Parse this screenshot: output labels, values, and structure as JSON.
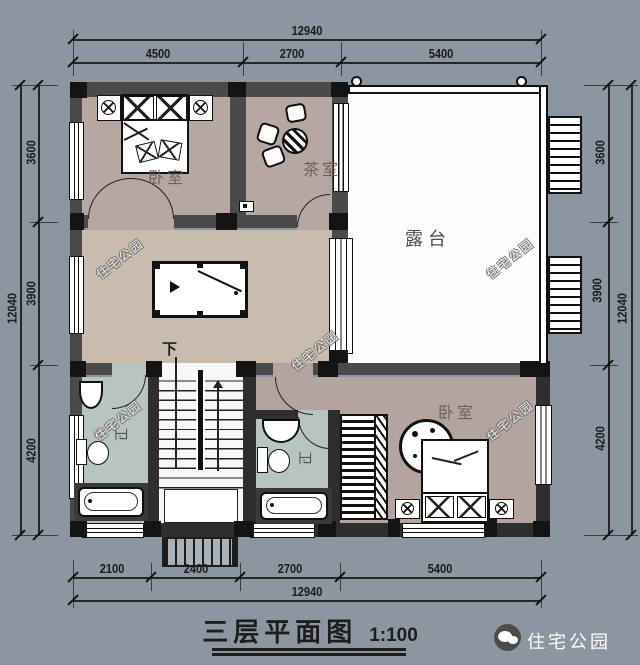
{
  "title": {
    "text": "三层平面图",
    "scale": "1:100"
  },
  "brand": {
    "name": "住宅公园",
    "watermark": "住宅公园"
  },
  "rooms": {
    "bedroom1": "卧室",
    "tea": "茶室",
    "terrace": "露台",
    "bedroom2": "卧室",
    "bath1": "卫",
    "bath2": "卫",
    "stair_down": "下"
  },
  "dims": {
    "top": {
      "total": "12940",
      "segments": [
        "4500",
        "2700",
        "5400"
      ]
    },
    "bottom": {
      "total": "12940",
      "segments": [
        "2100",
        "2400",
        "2700",
        "5400"
      ]
    },
    "left": {
      "total": "12040",
      "segments": [
        "3600",
        "3900",
        "4200"
      ]
    },
    "right": {
      "total": "12040",
      "segments": [
        "3600",
        "3900",
        "4200"
      ]
    }
  },
  "colors": {
    "background": "#8B96A0",
    "wall_fill": "#4A4A4A",
    "column": "#141414",
    "floor_bedroom": "#B6A7A3",
    "floor_hall": "#C9BCAE",
    "floor_bath": "#B7C4C0",
    "floor_terrace": "#FCFCFC",
    "dim_text": "#1B1B1B",
    "watermark_text": "#FAFAFA"
  }
}
